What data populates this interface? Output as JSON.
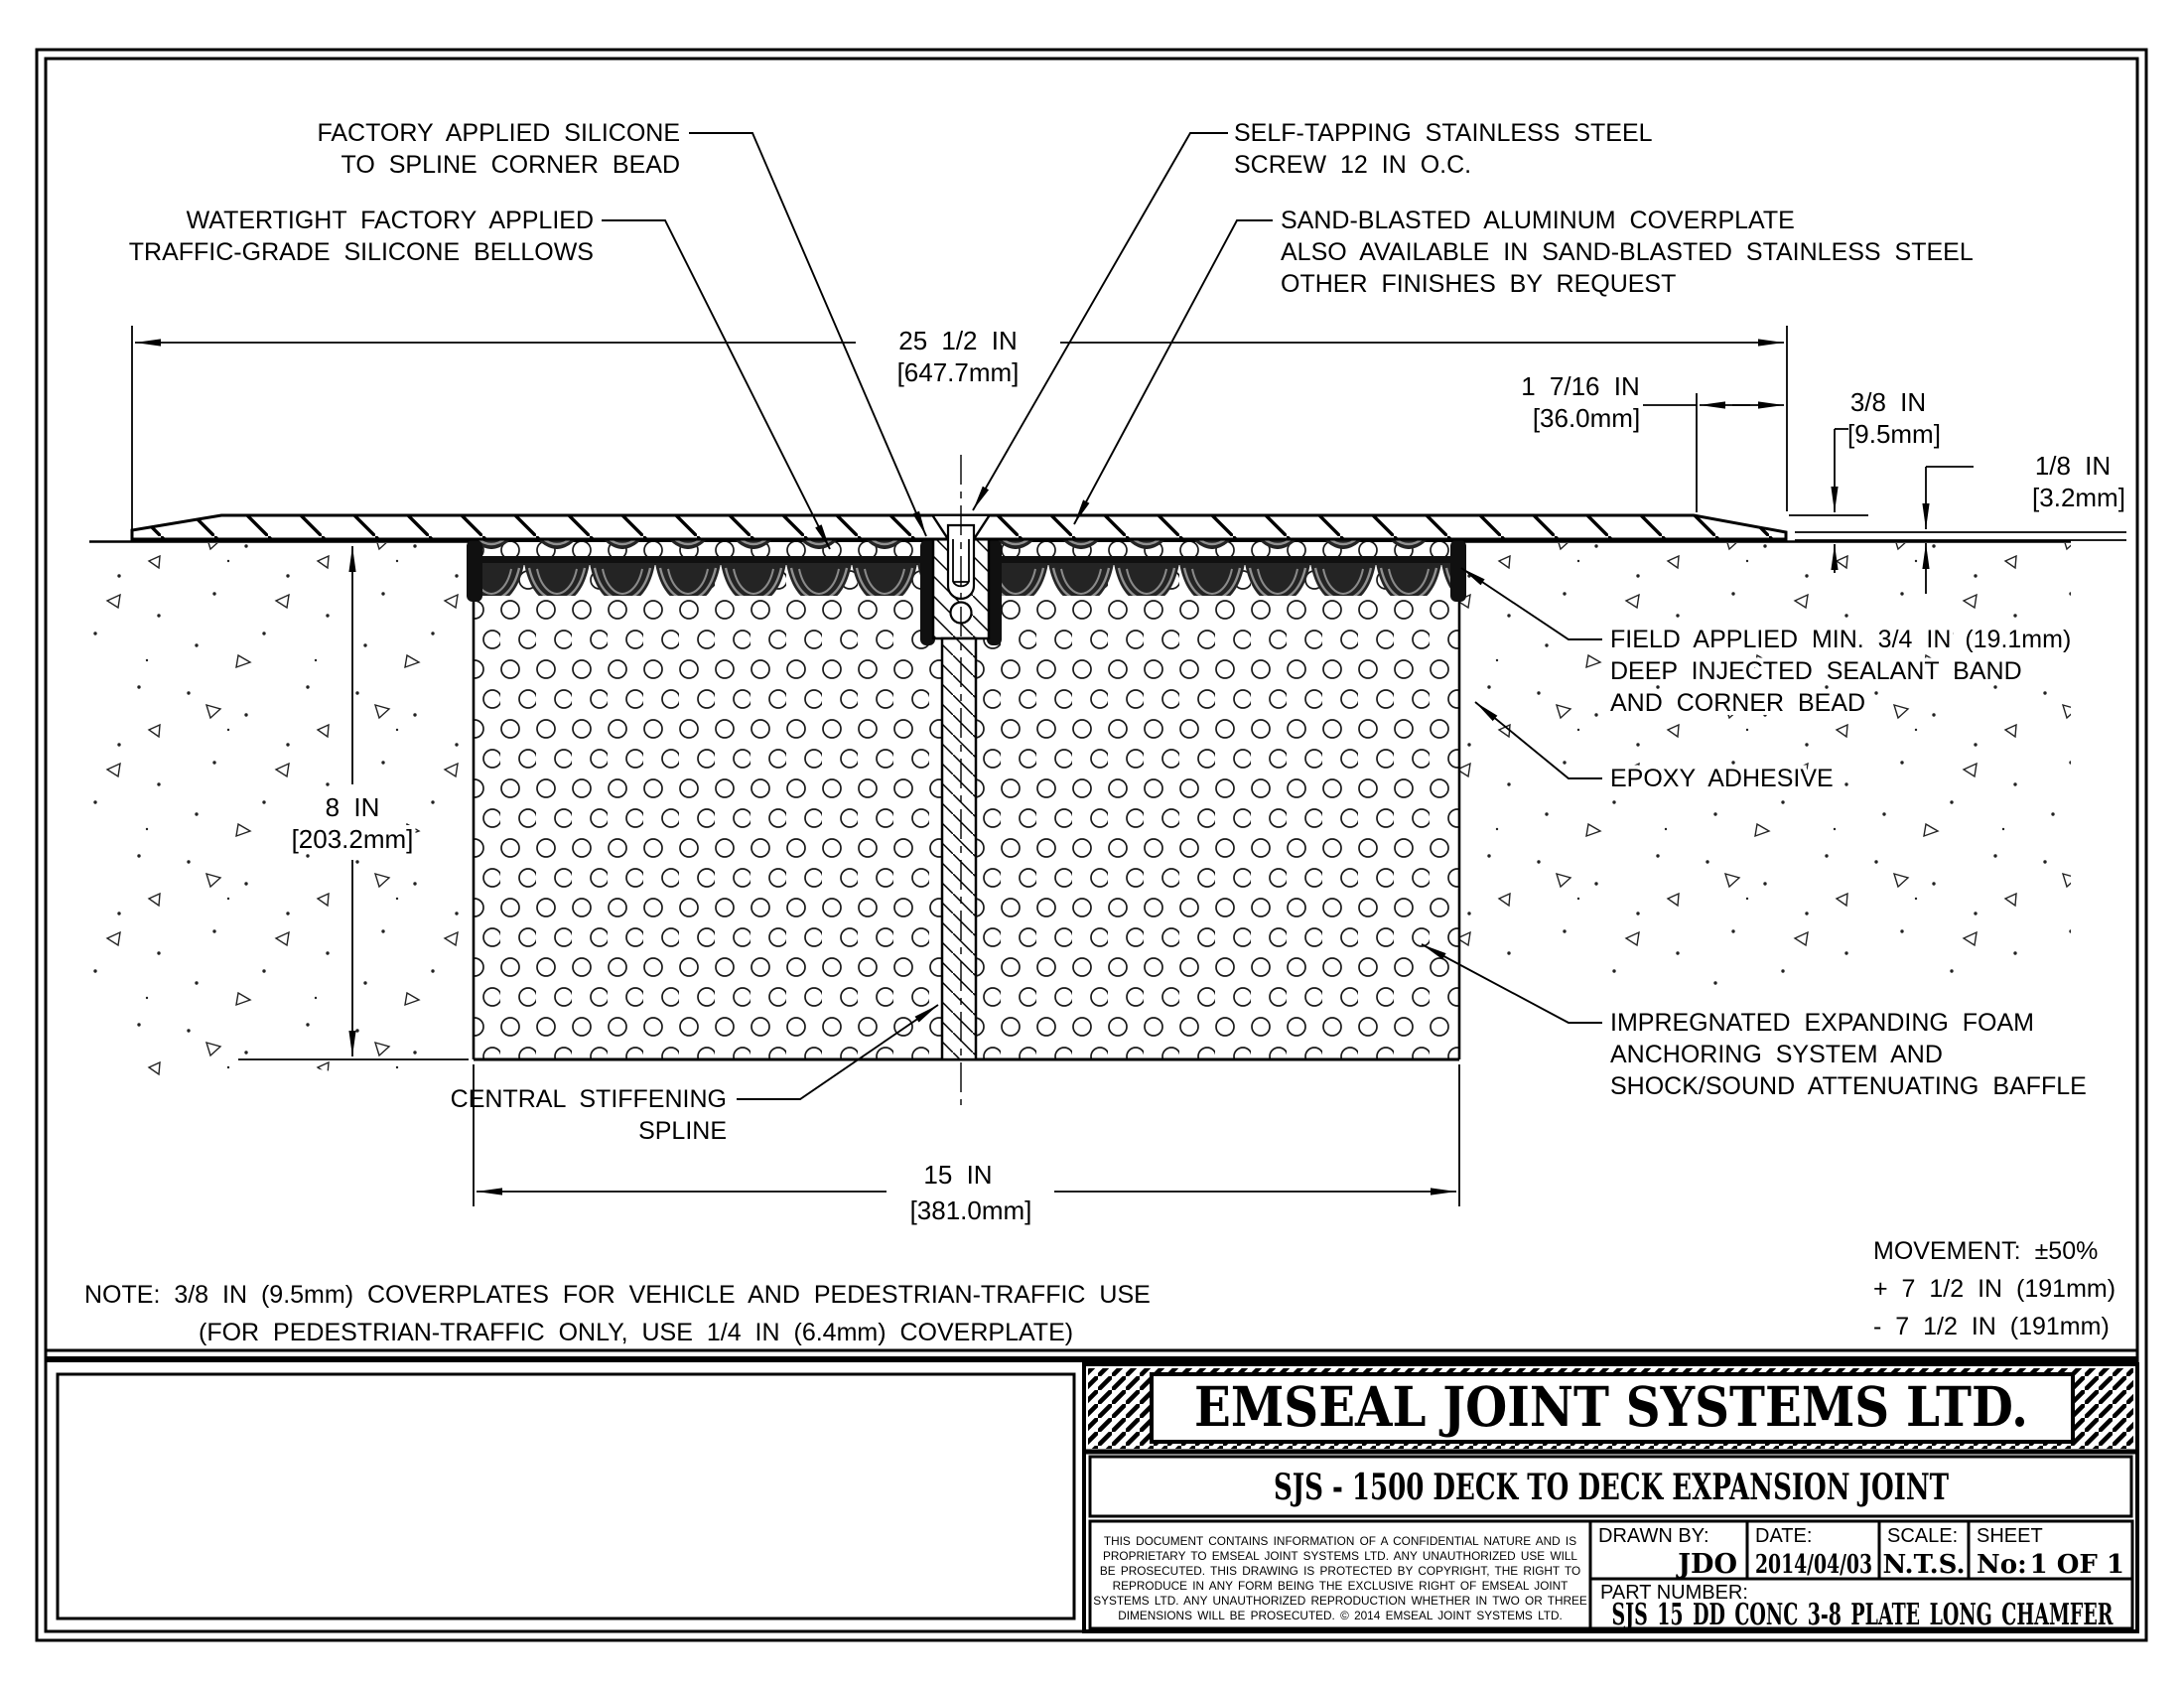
{
  "drawing": {
    "labels": {
      "factory_silicone": [
        "FACTORY APPLIED SILICONE",
        "TO SPLINE CORNER BEAD"
      ],
      "bellows": [
        "WATERTIGHT FACTORY APPLIED",
        "TRAFFIC-GRADE SILICONE BELLOWS"
      ],
      "screw": [
        "SELF-TAPPING STAINLESS STEEL",
        "SCREW 12 IN O.C."
      ],
      "coverplate": [
        "SAND-BLASTED ALUMINUM COVERPLATE",
        "ALSO AVAILABLE IN SAND-BLASTED STAINLESS STEEL",
        "OTHER FINISHES BY REQUEST"
      ],
      "sealant_band": [
        "FIELD APPLIED MIN. 3/4 IN (19.1mm)",
        "DEEP INJECTED SEALANT BAND",
        "AND CORNER BEAD"
      ],
      "epoxy": [
        "EPOXY ADHESIVE"
      ],
      "foam": [
        "IMPREGNATED EXPANDING FOAM",
        "ANCHORING SYSTEM AND",
        "SHOCK/SOUND ATTENUATING BAFFLE"
      ],
      "spline": [
        "CENTRAL STIFFENING",
        "SPLINE"
      ]
    },
    "dimensions": {
      "overall_width": [
        "25 1/2 IN",
        "[647.7mm]"
      ],
      "chamfer_length": [
        "1 7/16 IN",
        "[36.0mm]"
      ],
      "plate_thickness": [
        "3/8 IN",
        "[9.5mm]"
      ],
      "edge_thickness": [
        "1/8 IN",
        "[3.2mm]"
      ],
      "depth": [
        "8 IN",
        "[203.2mm]"
      ],
      "joint_width": [
        "15 IN",
        "[381.0mm]"
      ]
    },
    "note": [
      "NOTE: 3/8 IN (9.5mm) COVERPLATES FOR VEHICLE AND PEDESTRIAN-TRAFFIC USE",
      "(FOR PEDESTRIAN-TRAFFIC ONLY, USE 1/4 IN (6.4mm) COVERPLATE)"
    ],
    "movement": [
      "MOVEMENT: ±50%",
      "+ 7 1/2 IN (191mm)",
      "- 7 1/2 IN (191mm)"
    ]
  },
  "title_block": {
    "company": "EMSEAL JOINT SYSTEMS LTD.",
    "drawing_title": "SJS - 1500 DECK TO DECK EXPANSION JOINT",
    "disclaimer": [
      "THIS DOCUMENT CONTAINS INFORMATION OF A CONFIDENTIAL NATURE AND IS",
      "PROPRIETARY TO EMSEAL JOINT SYSTEMS LTD. ANY UNAUTHORIZED USE WILL",
      "BE PROSECUTED. THIS DRAWING IS PROTECTED BY COPYRIGHT, THE RIGHT TO",
      "REPRODUCE IN ANY FORM BEING THE EXCLUSIVE RIGHT OF EMSEAL JOINT",
      "SYSTEMS LTD. ANY UNAUTHORIZED REPRODUCTION WHETHER IN TWO OR THREE",
      "DIMENSIONS WILL BE PROSECUTED. © 2014 EMSEAL JOINT SYSTEMS LTD."
    ],
    "drawn_by_label": "DRAWN BY:",
    "drawn_by": "JDO",
    "date_label": "DATE:",
    "date": "2014/04/03",
    "scale_label": "SCALE:",
    "scale": "N.T.S.",
    "sheet_label": "SHEET",
    "sheet_no_label": "No:",
    "sheet": "1 OF 1",
    "part_number_label": "PART NUMBER:",
    "part_number": "SJS_15_DD_CONC_3-8_PLATE_LONG_CHAMFER"
  }
}
